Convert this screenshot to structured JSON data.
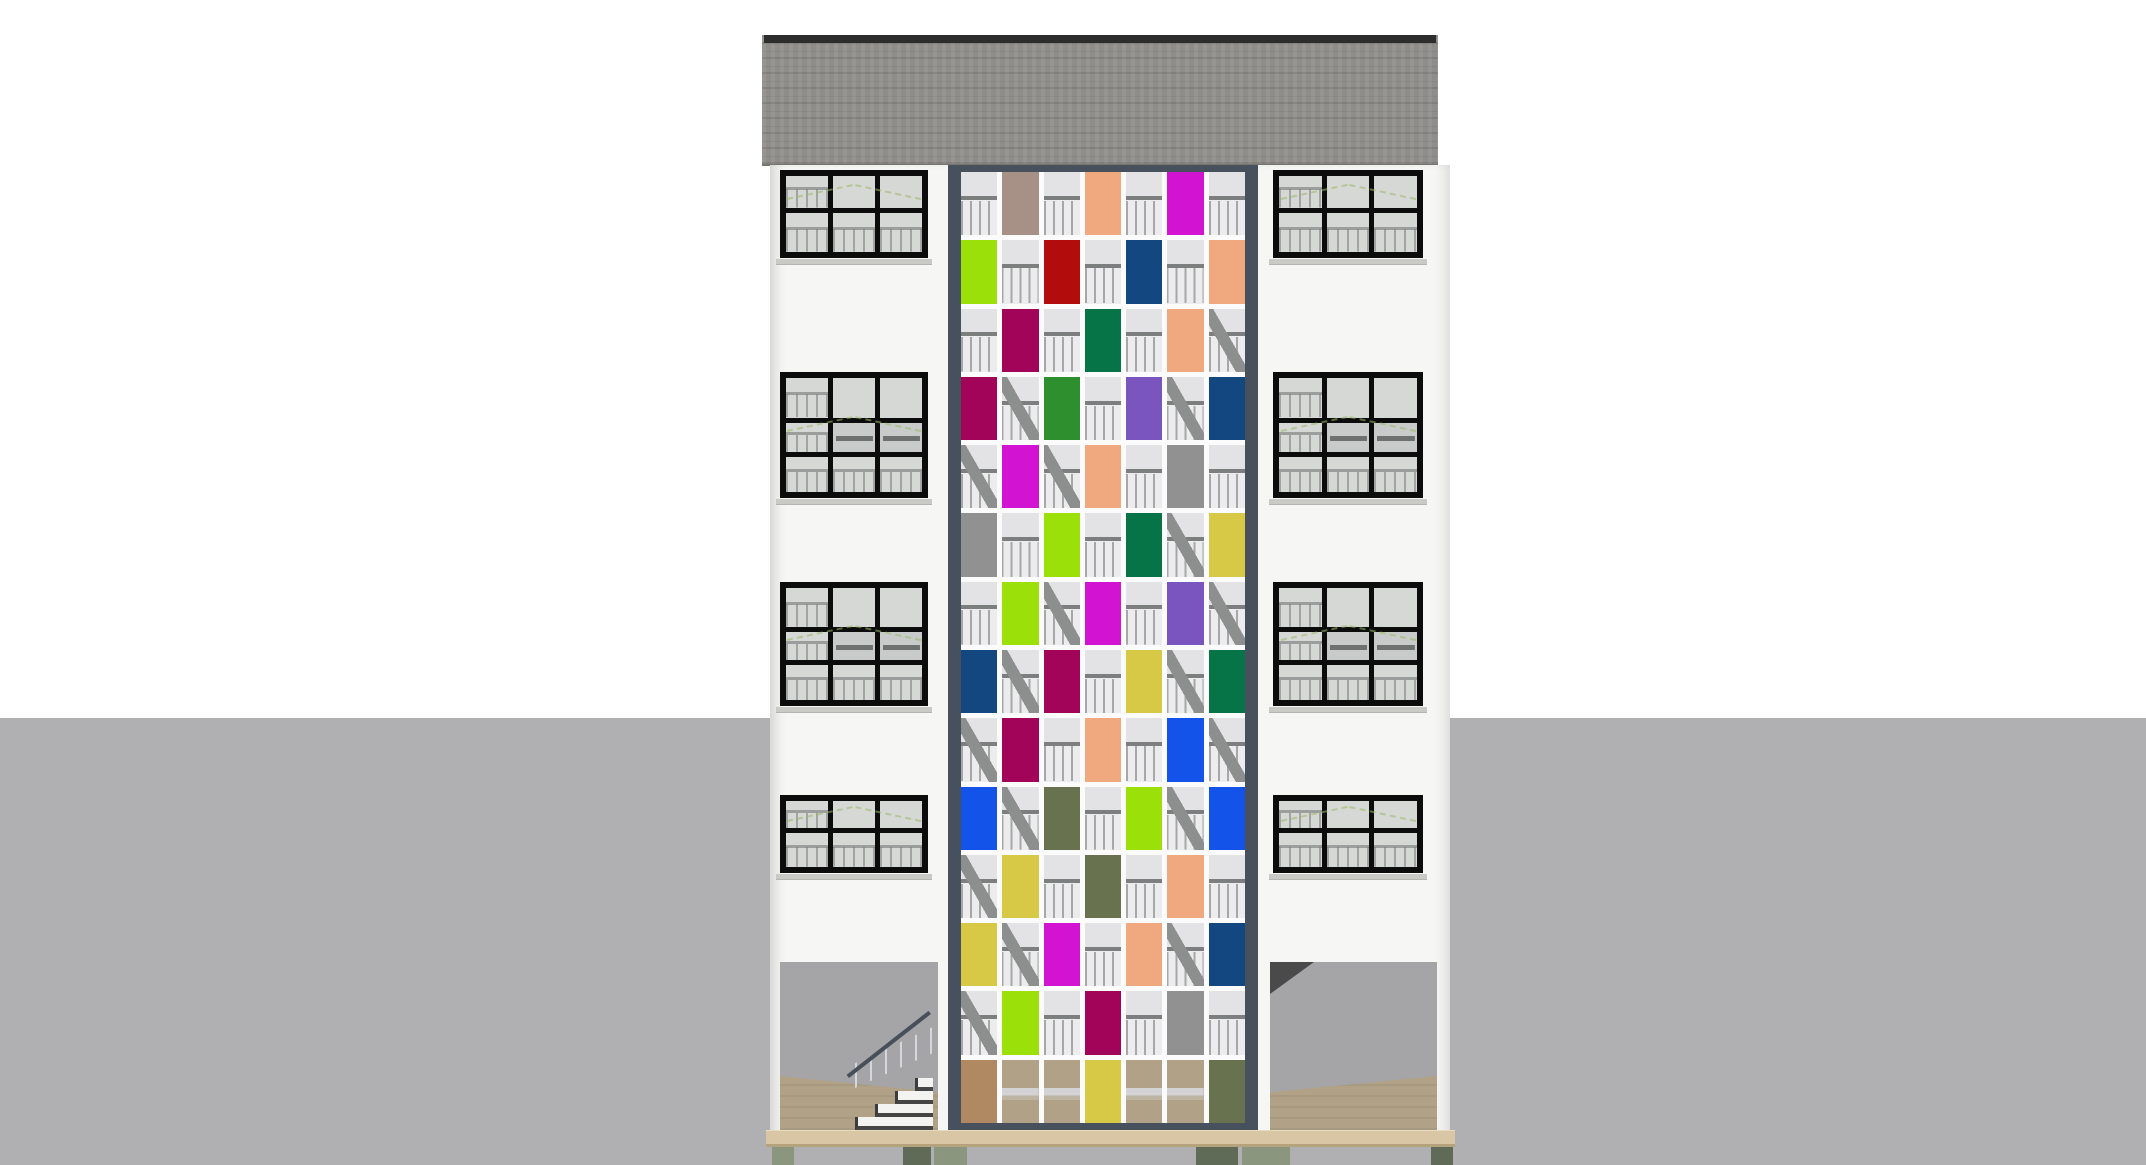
{
  "scene": {
    "description": "architectural-elevation-render",
    "canvas": {
      "width": 2146,
      "height": 1165
    }
  },
  "colors": {
    "sky": "#ffffff",
    "ground": "#b0b0b2",
    "roof": "#8e8d8a",
    "roof_ridge": "#2d2d2d",
    "facade": "#f6f6f4",
    "window_frame": "#0c0c0c",
    "glass": "#d6d8d6",
    "sill": "#c9c9c6",
    "shaft_frame": "#47505d",
    "grid_gap": "#fbfbfb",
    "slab": "#d8c6a4",
    "slab_edge": "#b5a37e",
    "wood_floor": "#b1a287",
    "opening": "#a5a5a7",
    "pier_dark": "#5f6b56",
    "pier_light": "#8a977e",
    "guide": "#9ab964"
  },
  "palette": {
    "magenta": "#d214d2",
    "taupe": "#a79086",
    "peach": "#f0a87e",
    "lime": "#9ce00a",
    "dark-red": "#b30c0c",
    "navy": "#12487f",
    "raspberry": "#a10459",
    "dark-green": "#077448",
    "green": "#2e8f2e",
    "purple": "#7a55c0",
    "gray": "#919191",
    "mustard": "#d7c845",
    "olive": "#68724f",
    "royal-blue": "#1353e9",
    "tan": "#b08862"
  },
  "panel_grid": {
    "rows": 14,
    "cols": 7,
    "panels": [
      {
        "r": 1,
        "c": 2,
        "color": "taupe"
      },
      {
        "r": 1,
        "c": 4,
        "color": "peach"
      },
      {
        "r": 1,
        "c": 6,
        "color": "magenta"
      },
      {
        "r": 2,
        "c": 1,
        "color": "lime"
      },
      {
        "r": 2,
        "c": 3,
        "color": "dark-red"
      },
      {
        "r": 2,
        "c": 5,
        "color": "navy"
      },
      {
        "r": 2,
        "c": 7,
        "color": "peach"
      },
      {
        "r": 3,
        "c": 2,
        "color": "raspberry"
      },
      {
        "r": 3,
        "c": 4,
        "color": "dark-green"
      },
      {
        "r": 3,
        "c": 6,
        "color": "peach"
      },
      {
        "r": 4,
        "c": 1,
        "color": "raspberry"
      },
      {
        "r": 4,
        "c": 3,
        "color": "green"
      },
      {
        "r": 4,
        "c": 5,
        "color": "purple"
      },
      {
        "r": 4,
        "c": 7,
        "color": "navy"
      },
      {
        "r": 5,
        "c": 2,
        "color": "magenta"
      },
      {
        "r": 5,
        "c": 4,
        "color": "peach"
      },
      {
        "r": 5,
        "c": 6,
        "color": "gray"
      },
      {
        "r": 6,
        "c": 1,
        "color": "gray"
      },
      {
        "r": 6,
        "c": 3,
        "color": "lime"
      },
      {
        "r": 6,
        "c": 5,
        "color": "dark-green"
      },
      {
        "r": 6,
        "c": 7,
        "color": "mustard"
      },
      {
        "r": 7,
        "c": 2,
        "color": "lime"
      },
      {
        "r": 7,
        "c": 4,
        "color": "magenta"
      },
      {
        "r": 7,
        "c": 6,
        "color": "purple"
      },
      {
        "r": 8,
        "c": 1,
        "color": "navy"
      },
      {
        "r": 8,
        "c": 3,
        "color": "raspberry"
      },
      {
        "r": 8,
        "c": 5,
        "color": "mustard"
      },
      {
        "r": 8,
        "c": 7,
        "color": "dark-green"
      },
      {
        "r": 9,
        "c": 2,
        "color": "raspberry"
      },
      {
        "r": 9,
        "c": 4,
        "color": "peach"
      },
      {
        "r": 9,
        "c": 6,
        "color": "royal-blue"
      },
      {
        "r": 10,
        "c": 1,
        "color": "royal-blue"
      },
      {
        "r": 10,
        "c": 3,
        "color": "olive"
      },
      {
        "r": 10,
        "c": 5,
        "color": "lime"
      },
      {
        "r": 10,
        "c": 7,
        "color": "royal-blue"
      },
      {
        "r": 11,
        "c": 2,
        "color": "mustard"
      },
      {
        "r": 11,
        "c": 4,
        "color": "olive"
      },
      {
        "r": 11,
        "c": 6,
        "color": "peach"
      },
      {
        "r": 12,
        "c": 1,
        "color": "mustard"
      },
      {
        "r": 12,
        "c": 3,
        "color": "magenta"
      },
      {
        "r": 12,
        "c": 5,
        "color": "peach"
      },
      {
        "r": 12,
        "c": 7,
        "color": "navy"
      },
      {
        "r": 13,
        "c": 2,
        "color": "lime"
      },
      {
        "r": 13,
        "c": 4,
        "color": "raspberry"
      },
      {
        "r": 13,
        "c": 6,
        "color": "gray"
      },
      {
        "r": 14,
        "c": 1,
        "color": "tan"
      },
      {
        "r": 14,
        "c": 4,
        "color": "mustard"
      },
      {
        "r": 14,
        "c": 7,
        "color": "olive"
      }
    ],
    "stair_cells": [
      [
        3,
        7
      ],
      [
        4,
        2
      ],
      [
        4,
        6
      ],
      [
        5,
        1
      ],
      [
        5,
        3
      ],
      [
        6,
        6
      ],
      [
        7,
        3
      ],
      [
        7,
        7
      ],
      [
        8,
        2
      ],
      [
        8,
        6
      ],
      [
        9,
        1
      ],
      [
        9,
        7
      ],
      [
        10,
        2
      ],
      [
        10,
        6
      ],
      [
        11,
        1
      ],
      [
        12,
        2
      ],
      [
        12,
        6
      ],
      [
        13,
        1
      ]
    ],
    "floor_row": 14
  },
  "windows": {
    "pane_cols": 3,
    "rows": [
      {
        "pane_rows": 2
      },
      {
        "pane_rows": 3
      },
      {
        "pane_rows": 3
      },
      {
        "pane_rows": 2
      }
    ]
  }
}
